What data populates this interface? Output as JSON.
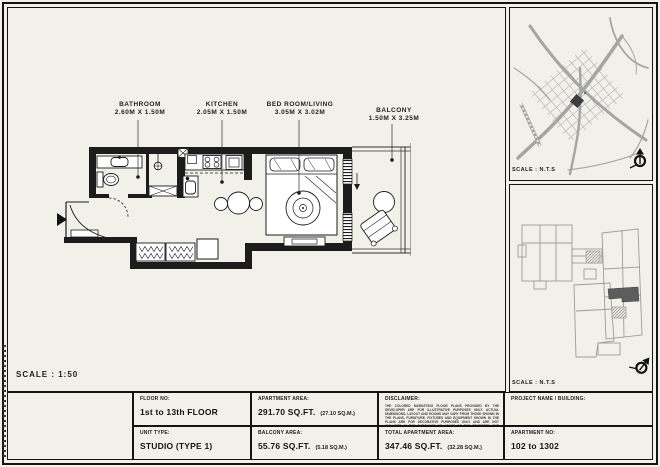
{
  "colors": {
    "paper": "#f1f0e9",
    "ink": "#1c1c1c",
    "map_gray": "#a9a9a9",
    "unit_highlight": "#5d5d5d"
  },
  "main": {
    "scale_label": "SCALE : 1:50"
  },
  "floor_plan": {
    "labels": [
      {
        "name": "BATHROOM",
        "dims": "2.60M X 1.50M"
      },
      {
        "name": "KITCHEN",
        "dims": "2.05M X 1.50M"
      },
      {
        "name": "BED ROOM/LIVING",
        "dims": "3.05M X 3.02M"
      },
      {
        "name": "BALCONY",
        "dims": "1.50M X 3.25M"
      }
    ]
  },
  "location_map": {
    "scale_label": "SCALE : N.T.S"
  },
  "key_plan": {
    "scale_label": "SCALE : N.T.S"
  },
  "title_block": {
    "floor_no": {
      "label": "FLOOR NO:",
      "value": "1st to 13th FLOOR"
    },
    "unit_type": {
      "label": "UNIT TYPE:",
      "value": "STUDIO (TYPE 1)"
    },
    "apartment_area": {
      "label": "APARTMENT AREA:",
      "value": "291.70 SQ.FT.",
      "metric": "(27.10 SQ.M.)"
    },
    "balcony_area": {
      "label": "BALCONY AREA:",
      "value": "55.76 SQ.FT.",
      "metric": "(5.18 SQ.M.)"
    },
    "total_apartment_area": {
      "label": "TOTAL APARTMENT AREA:",
      "value": "347.46 SQ.FT.",
      "metric": "(32.28 SQ.M.)"
    },
    "disclaimer": {
      "label": "DISCLAIMER:",
      "text": "THE COLORED MARKETING FLOOR PLANS PROVIDED BY THE DEVELOPER ARE FOR ILLUSTRATIVE PURPOSES ONLY. ACTUAL DIMENSIONS, LAYOUT AND ROOMS MAY VARY FROM THOSE SHOWN IN THE PLANS. FURNITURE, FIXTURES AND EQUIPMENT SHOWN IN THE PLANS ARE FOR DECORATIVE PURPOSES ONLY AND ARE NOT INCLUDED IN THE PURCHASE OR LEASE OF THE PROPERTY. THE DEVELOPER RESERVES THE RIGHT TO MAKE MODIFICATIONS, REVISIONS, AND CHANGES TO THE FLOOR PLANS, SPECIFICATIONS, AND FEATURES WITHOUT PRIOR NOTICE."
    },
    "project_name": {
      "label": "PROJECT NAME / BUILDING:",
      "value": ""
    },
    "apartment_no": {
      "label": "APARTMENT NO:",
      "value": "102 to 1302"
    }
  },
  "icons": {
    "north_arrow": "north-arrow-compass",
    "entry_arrow": "entrance-direction-arrow"
  }
}
